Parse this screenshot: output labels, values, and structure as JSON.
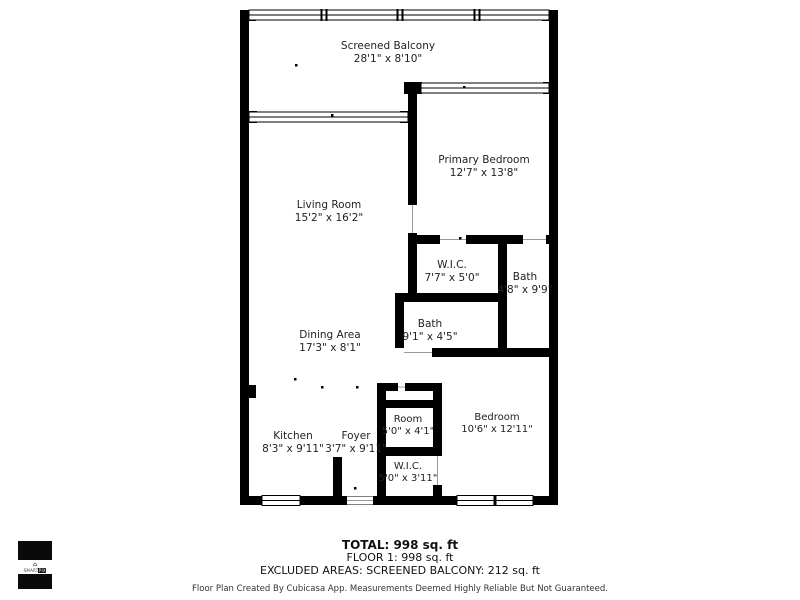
{
  "floorplan": {
    "rooms": [
      {
        "name": "Screened Balcony",
        "dims": "28'1\" x 8'10\""
      },
      {
        "name": "Primary Bedroom",
        "dims": "12'7\" x 13'8\""
      },
      {
        "name": "Living Room",
        "dims": "15'2\" x 16'2\""
      },
      {
        "name": "W.I.C.",
        "dims": "7'7\" x 5'0\""
      },
      {
        "name": "Bath",
        "dims": "4'8\" x 9'9\""
      },
      {
        "name": "Bath",
        "dims": "9'1\" x 4'5\""
      },
      {
        "name": "Dining Area",
        "dims": "17'3\" x 8'1\""
      },
      {
        "name": "Kitchen",
        "dims": "8'3\" x 9'11\""
      },
      {
        "name": "Foyer",
        "dims": "3'7\" x 9'11\""
      },
      {
        "name": "Room",
        "dims": "5'0\" x 4'1\""
      },
      {
        "name": "Bedroom",
        "dims": "10'6\" x 12'11\""
      },
      {
        "name": "W.I.C.",
        "dims": "5'0\" x 3'11\""
      }
    ],
    "summary": {
      "total": "TOTAL: 998 sq. ft",
      "floor": "FLOOR 1: 998 sq. ft",
      "excluded": "EXCLUDED AREAS: SCREENED BALCONY: 212 sq. ft"
    },
    "disclaimer": "Floor Plan Created By Cubicasa App. Measurements Deemed Highly Reliable But Not Guaranteed.",
    "logo": {
      "brand_left": "SMART",
      "brand_right": "PIX",
      "house_glyph": "⌂"
    },
    "colors": {
      "wall": "#000000",
      "background": "#ffffff",
      "text": "#222222"
    }
  }
}
